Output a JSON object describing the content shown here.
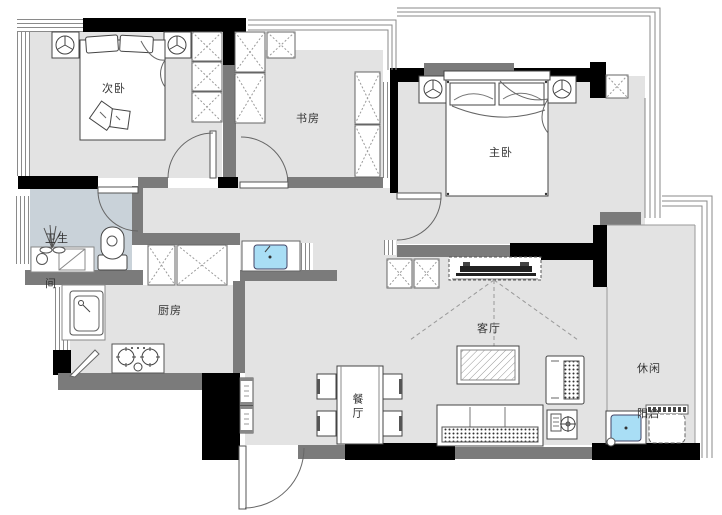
{
  "title": "apartment-floor-plan",
  "rooms": {
    "secondary_bedroom": "次卧",
    "study": "书房",
    "master_bedroom": "主卧",
    "bathroom_line1": "卫生",
    "bathroom_line2": "间",
    "kitchen": "厨房",
    "living_room": "客厅",
    "dining_room": "餐厅",
    "balcony_line1": "休闲",
    "balcony_line2": "阳台"
  },
  "colors": {
    "wall": "#000000",
    "partition": "#7b7b7b",
    "floor": "#e3e3e3",
    "bathroom_floor": "#c9d2d9",
    "basin": "#a9def5",
    "line": "#555555",
    "label": "#333333"
  }
}
